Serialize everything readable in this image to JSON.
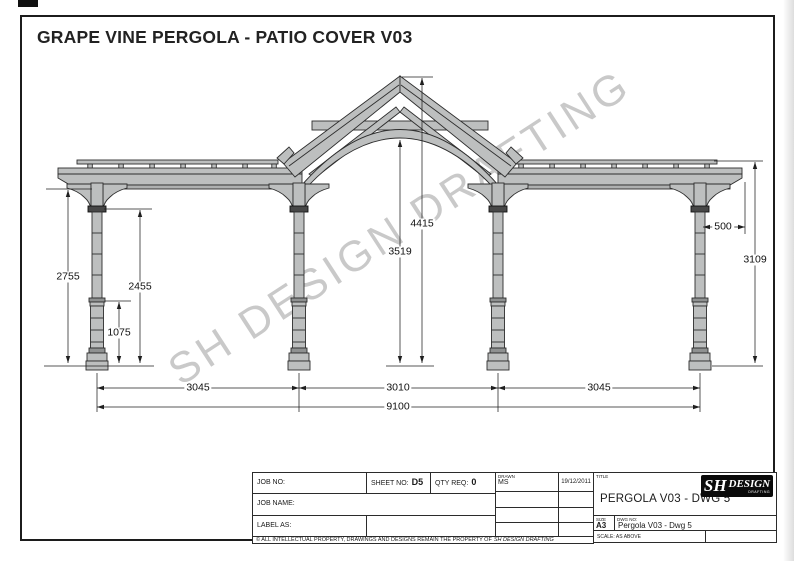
{
  "page": {
    "title": "GRAPE VINE PERGOLA - PATIO COVER V03",
    "watermark": "SH DESIGN DRAFTING"
  },
  "colors": {
    "timber_fill": "#bdbfbf",
    "outline": "#2d2d2d",
    "dark_collar": "#474747",
    "watermark_gray": "#9d9d9d"
  },
  "dims": {
    "peak_height": "4415",
    "arch_underside": "3519",
    "side_height_right": "3109",
    "overhang": "500",
    "beam_underside_left": "2755",
    "capital_height": "2455",
    "lower_shaft": "1075",
    "bay_left": "3045",
    "bay_center": "3010",
    "bay_right": "3045",
    "total_width": "9100"
  },
  "title_block": {
    "job_no_label": "JOB NO:",
    "sheet_no_label": "SHEET NO:",
    "sheet_no_value": "D5",
    "qty_req_label": "QTY REQ:",
    "qty_req_value": "0",
    "drawn_label": "DRAWN",
    "drawn_value": "MS",
    "date_value": "19/12/2011",
    "job_name_label": "JOB NAME:",
    "label_as_label": "LABEL AS:",
    "title_label": "TITLE",
    "title_value": "PERGOLA V03 - DWG 5",
    "size_label": "SIZE",
    "size_value": "A3",
    "dwg_no_label": "DWG NO:",
    "dwg_no_value": "Pergola V03 - Dwg 5",
    "scale_label": "SCALE:",
    "scale_value": "AS ABOVE",
    "copyright": "© ALL INTELLECTUAL PROPERTY, DRAWINGS AND DESIGNS REMAIN THE PROPERTY OF",
    "copyright_emphasis": "SH DESIGN DRAFTING",
    "logo_monogram": "SH",
    "logo_name": "DESIGN",
    "logo_sub": "DRAFTING"
  }
}
